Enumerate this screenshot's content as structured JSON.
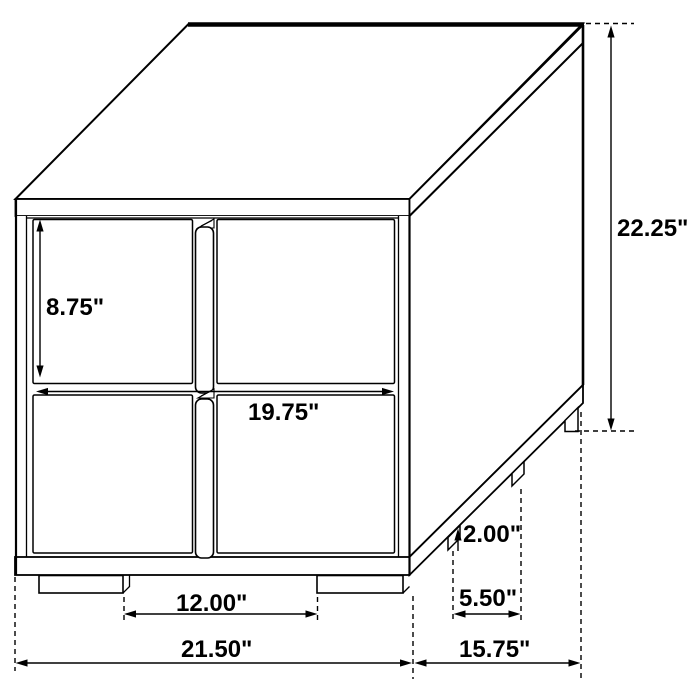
{
  "page": {
    "background": "#ffffff"
  },
  "diagram": {
    "colors": {
      "line": "#000000",
      "fill": "#ffffff"
    },
    "labels": {
      "drawer_height": "8.75\"",
      "drawer_width": "19.75\"",
      "overall_height": "22.25\"",
      "base_rail_height": "2.00\"",
      "side_leg_spacing": "5.50\"",
      "front_leg_gap": "12.00\"",
      "overall_width": "21.50\"",
      "overall_depth": "15.75\""
    }
  }
}
